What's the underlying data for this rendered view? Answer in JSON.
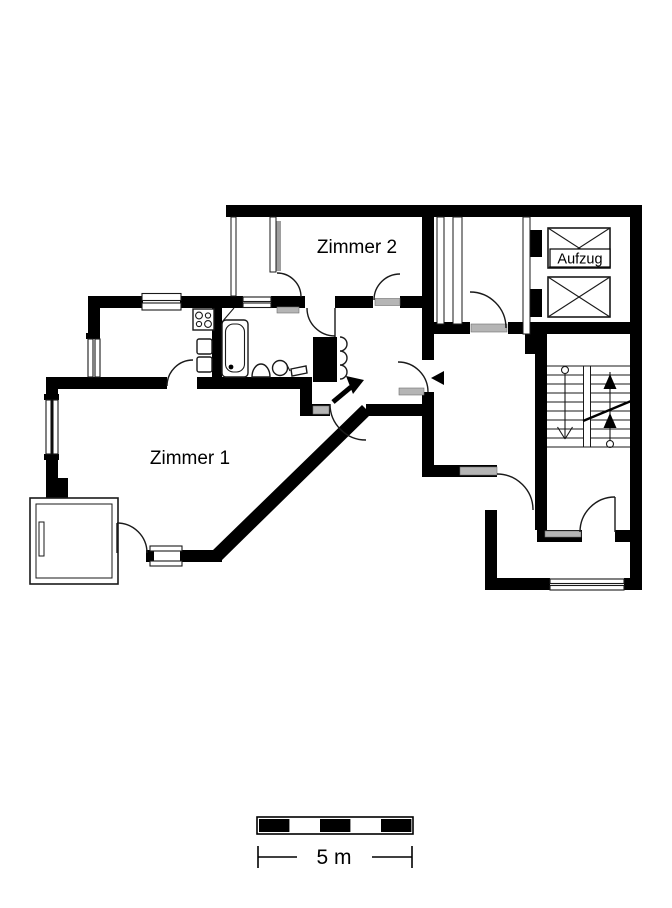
{
  "page": {
    "background": "#ffffff"
  },
  "plan": {
    "rooms": [
      {
        "id": "zimmer2",
        "label": "Zimmer 2"
      },
      {
        "id": "zimmer1",
        "label": "Zimmer 1"
      }
    ],
    "elevator": {
      "label": "Aufzug",
      "shaft_count": 2
    },
    "fixtures": [
      "stove-icon",
      "kitchen-sink-icon",
      "bathtub-icon",
      "washbasin-icon",
      "toilet-icon",
      "accordion-door-icon",
      "staircase-icon",
      "elevator-shaft-icon",
      "balcony-icon",
      "loggia-icon",
      "entrance-arrow-icon",
      "entrance-triangle-icon"
    ],
    "stairs": {
      "flights": 2,
      "up_arrows": 2,
      "down_arrows": 1
    },
    "colors": {
      "wall": "#000000",
      "background": "#ffffff",
      "window": "#9e9e9e",
      "threshold": "#b5b5b5"
    }
  },
  "scale_bar": {
    "label": "5 m",
    "segments": 5
  }
}
